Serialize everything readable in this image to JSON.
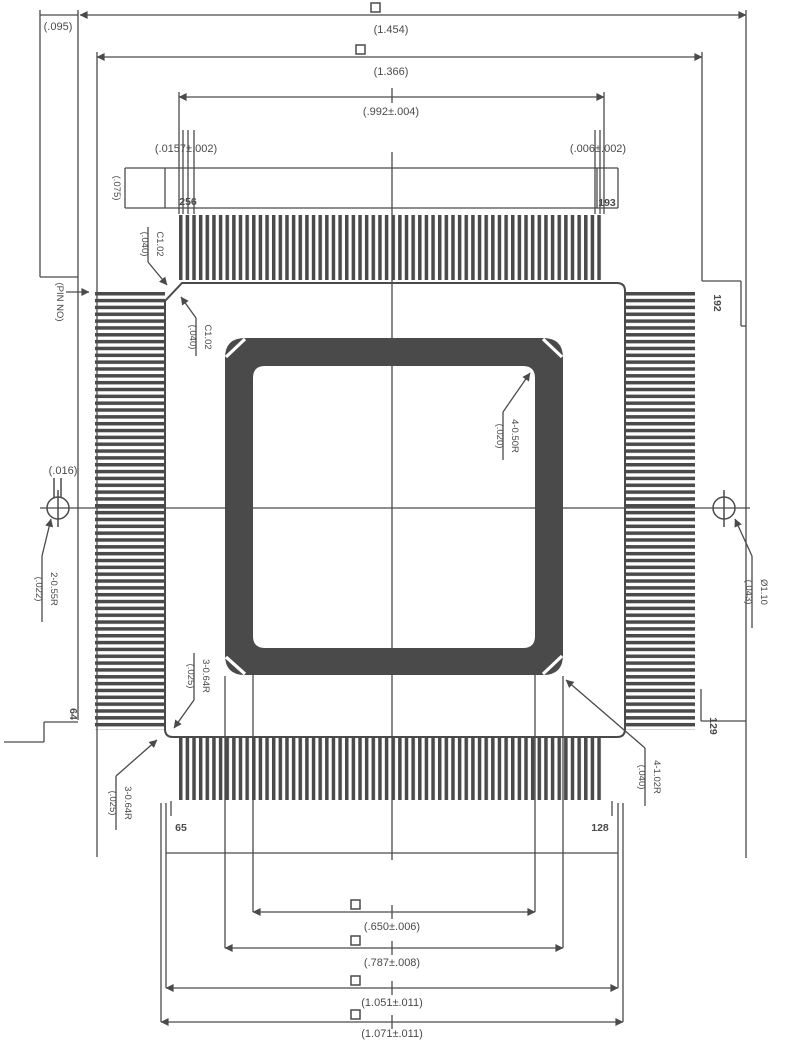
{
  "drawing": {
    "title_hint": "QFP-256 package mechanical outline drawing",
    "ink_color": "#4a4a4a",
    "dims_top": {
      "overall": "(1.454)",
      "outer_body": "(1.366)",
      "lead_span": "(.992±.004)",
      "edge_offset": "(.095)"
    },
    "dims_bottom": {
      "pad_inner": "(.650±.006)",
      "pad_outer": "(.787±.008)",
      "tip_span": "(1.051±.011)",
      "overall": "(1.071±.011)"
    },
    "lead": {
      "pitch": "(.0157±.002)",
      "width": "(.006±.002)",
      "length": "(.075)"
    },
    "callouts": {
      "chamfer_value": "C1.02",
      "chamfer_ref": "(.040)",
      "corner_bl_value": "3-0.64R",
      "corner_bl_ref": "(.025)",
      "pad_corner_value": "4-1.02R",
      "pad_corner_ref": "(.040)",
      "inner_corner_value": "4-0.50R",
      "inner_corner_ref": "(.020)",
      "left_hole_value": "2-0.55R",
      "left_hole_ref": "(.022)",
      "left_hole_width": "(.016)",
      "right_hole_value": "Ø1.10",
      "right_hole_ref": "(.043)",
      "pin_no_note": "(PIN NO)"
    },
    "pin_numbers": {
      "top_left": "256",
      "top_right": "193",
      "right_top": "192",
      "right_bottom": "129",
      "bottom_right": "128",
      "bottom_left": "65",
      "left_bottom": "64"
    }
  }
}
